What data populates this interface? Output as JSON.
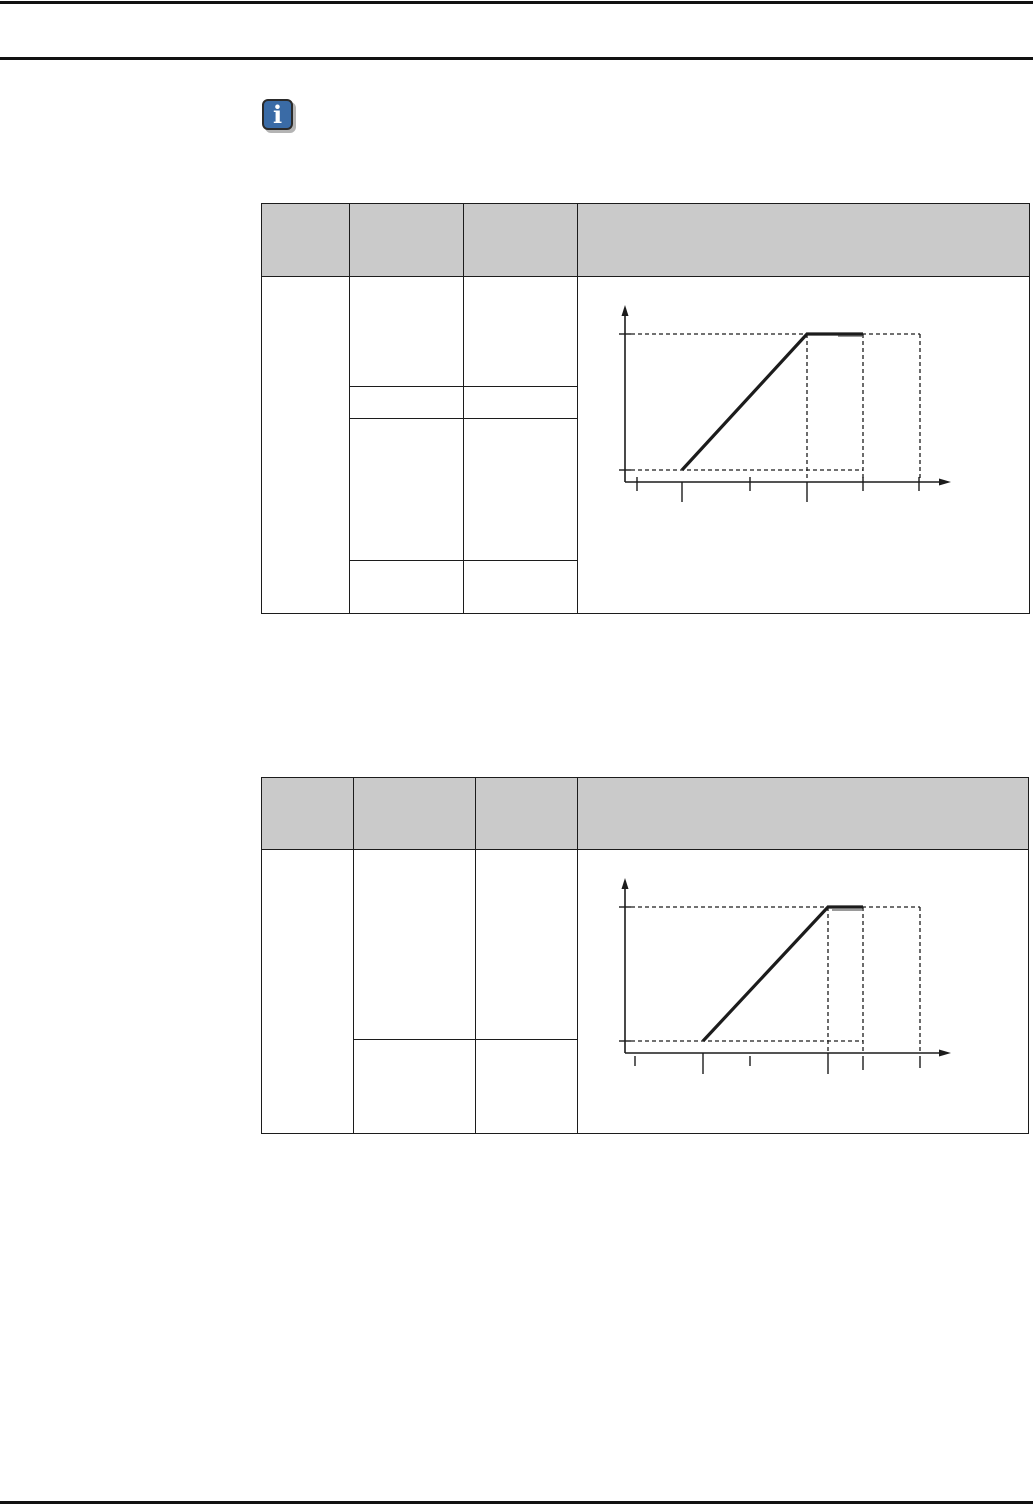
{
  "page": {
    "background": "#ffffff",
    "line_color": "#1c1c1c",
    "rule_color": "#111111",
    "header_fill": "#cacaca"
  },
  "info_icon": {
    "glyph": "i",
    "fill": "#3a6ba6",
    "border": "#2b2b2b",
    "shadow": "#b4b4b4",
    "glyph_color": "#ffffff"
  },
  "tables": [
    {
      "name": "table-1",
      "header_fill": "#cacaca",
      "border_color": "#1c1c1c",
      "headers": [
        "",
        "",
        "",
        ""
      ],
      "col1_text": "",
      "rows": [
        [
          "",
          ""
        ],
        [
          "",
          ""
        ],
        [
          "",
          ""
        ],
        [
          "",
          ""
        ]
      ],
      "figure": "ramp-plateau-diagram-1"
    },
    {
      "name": "table-2",
      "header_fill": "#cacaca",
      "border_color": "#1c1c1c",
      "headers": [
        "",
        "",
        "",
        ""
      ],
      "col1_text": "",
      "rows": [
        [
          "",
          ""
        ],
        [
          "",
          ""
        ]
      ],
      "figure": "ramp-plateau-diagram-2"
    }
  ],
  "chart_data": [
    {
      "type": "line",
      "name": "ramp-plateau-diagram-1",
      "title": "",
      "xlabel": "",
      "ylabel": "",
      "legend": "none",
      "grid": "off",
      "axes": {
        "x": 625,
        "y_bottom": 482,
        "y_arrow_tip": 305,
        "x_arrow_tip": 951
      },
      "series": [
        {
          "name": "signal-ramp",
          "points": [
            [
              682,
              470
            ],
            [
              807,
              334
            ],
            [
              863,
              334
            ]
          ]
        }
      ],
      "accent_segments": [
        {
          "x1": 838,
          "y": 336,
          "x2": 862,
          "color": "#9a9a9a"
        }
      ],
      "guides_h": [
        {
          "y": 334,
          "x1": 631,
          "x2": 920
        },
        {
          "y": 470,
          "x1": 631,
          "x2": 863
        }
      ],
      "guides_v": [
        {
          "x": 807,
          "y1": 334,
          "y2": 481
        },
        {
          "x": 863,
          "y1": 334,
          "y2": 481
        },
        {
          "x": 920,
          "y1": 334,
          "y2": 481
        }
      ],
      "ticks_x": [
        {
          "x": 637,
          "y1": 477,
          "y2": 491
        },
        {
          "x": 682,
          "y1": 482,
          "y2": 502
        },
        {
          "x": 750,
          "y1": 477,
          "y2": 491
        },
        {
          "x": 807,
          "y1": 482,
          "y2": 502
        },
        {
          "x": 863,
          "y1": 477,
          "y2": 491
        },
        {
          "x": 919,
          "y1": 477,
          "y2": 491
        }
      ],
      "ticks_y": [
        {
          "y": 334,
          "x1": 619,
          "x2": 631
        },
        {
          "y": 470,
          "x1": 619,
          "x2": 631
        }
      ]
    },
    {
      "type": "line",
      "name": "ramp-plateau-diagram-2",
      "title": "",
      "xlabel": "",
      "ylabel": "",
      "legend": "none",
      "grid": "off",
      "axes": {
        "x": 625,
        "y_bottom": 1053,
        "y_arrow_tip": 878,
        "x_arrow_tip": 951
      },
      "series": [
        {
          "name": "signal-ramp",
          "points": [
            [
              703,
              1041
            ],
            [
              828,
              907
            ],
            [
              863,
              907
            ]
          ]
        }
      ],
      "accent_segments": [
        {
          "x1": 832,
          "y": 910,
          "x2": 862,
          "color": "#9a9a9a"
        }
      ],
      "guides_h": [
        {
          "y": 907,
          "x1": 631,
          "x2": 920
        },
        {
          "y": 1041,
          "x1": 631,
          "x2": 863
        }
      ],
      "guides_v": [
        {
          "x": 828,
          "y1": 907,
          "y2": 1052
        },
        {
          "x": 863,
          "y1": 907,
          "y2": 1052
        },
        {
          "x": 920,
          "y1": 907,
          "y2": 1052
        }
      ],
      "ticks_x": [
        {
          "x": 635,
          "y1": 1056,
          "y2": 1066
        },
        {
          "x": 703,
          "y1": 1053,
          "y2": 1074
        },
        {
          "x": 750,
          "y1": 1056,
          "y2": 1066
        },
        {
          "x": 828,
          "y1": 1053,
          "y2": 1074
        },
        {
          "x": 863,
          "y1": 1056,
          "y2": 1070
        },
        {
          "x": 920,
          "y1": 1056,
          "y2": 1068
        }
      ],
      "ticks_y": [
        {
          "y": 907,
          "x1": 619,
          "x2": 631
        },
        {
          "y": 1041,
          "x1": 619,
          "x2": 631
        }
      ]
    }
  ]
}
